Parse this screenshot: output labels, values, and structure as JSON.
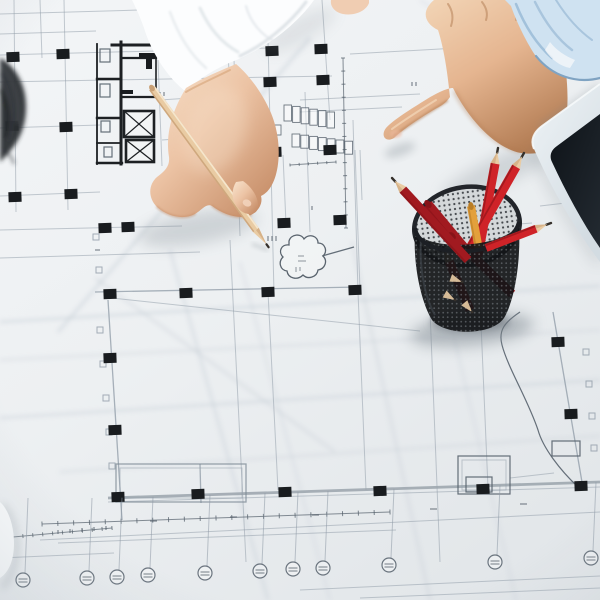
{
  "meta": {
    "title": "Architects reviewing blueprints",
    "description": "Top-down photo of two people over an architectural floor plan: one hand in a white sleeve holds a wooden pencil, another hand in a light blue sleeve points at the drawing, beside a black mesh cup full of red pencils and the corner of a tablet."
  },
  "colors": {
    "paper_hi": "#f3f5f7",
    "paper": "#edf0f2",
    "paper_lo": "#e3e7ea",
    "line": "#8e9aa6",
    "line_dark": "#55606b",
    "thick_gray": "#9aa4ac",
    "ink": "#191c1f",
    "wall": "#1d2023",
    "crease": "#c2cbd3",
    "skin_left": "#ecc3a4",
    "skin_left_hi": "#f8e3cd",
    "skin_left_sh": "#c48a64",
    "skin_right": "#e5b590",
    "skin_right_hi": "#f4d9bb",
    "skin_right_sh": "#b07950",
    "sleeve_white": "#fcfdfe",
    "sleeve_white_sh": "#e0e5e9",
    "sleeve_blue": "#cfe2f1",
    "sleeve_blue_sh": "#8fb3d1",
    "pencil_wood": "#e9cba3",
    "pencil_wood_dark": "#c9a075",
    "lead": "#35302b",
    "red": "#cf2328",
    "red_dark": "#a11a20",
    "red_deep": "#871318",
    "orange": "#e3a03c",
    "cup": "#131518",
    "cup_dot": "#878d93",
    "cup_interior": "#d4d8da",
    "tablet_bezel": "#e6edf2",
    "tablet_screen": "#161b21",
    "hair": "#2c2e32",
    "sheet": "#f8fafb",
    "shadow": "#7e8890"
  },
  "blueprint": {
    "columns": [
      [
        13,
        57
      ],
      [
        63,
        54
      ],
      [
        272,
        51
      ],
      [
        321,
        49
      ],
      [
        270,
        82
      ],
      [
        323,
        80
      ],
      [
        12,
        126
      ],
      [
        66,
        127
      ],
      [
        15,
        197
      ],
      [
        71,
        194
      ],
      [
        105,
        228
      ],
      [
        128,
        227
      ],
      [
        275,
        152
      ],
      [
        330,
        150
      ],
      [
        284,
        223
      ],
      [
        340,
        220
      ],
      [
        110,
        294
      ],
      [
        186,
        293
      ],
      [
        268,
        292
      ],
      [
        355,
        290
      ],
      [
        110,
        358
      ],
      [
        115,
        430
      ],
      [
        118,
        497
      ],
      [
        198,
        494
      ],
      [
        285,
        492
      ],
      [
        380,
        491
      ],
      [
        483,
        489
      ],
      [
        581,
        486
      ],
      [
        558,
        342
      ],
      [
        571,
        414
      ]
    ],
    "bubbles": [
      [
        23,
        580
      ],
      [
        87,
        578
      ],
      [
        117,
        577
      ],
      [
        148,
        575
      ],
      [
        205,
        573
      ],
      [
        260,
        571
      ],
      [
        293,
        569
      ],
      [
        323,
        568
      ],
      [
        389,
        565
      ],
      [
        495,
        562
      ],
      [
        591,
        558
      ]
    ],
    "tick_rows": [
      [
        42,
        524,
        390,
        512,
        22,
        5
      ],
      [
        343,
        58,
        346,
        228,
        13,
        4
      ],
      [
        290,
        165,
        336,
        162,
        5,
        3
      ],
      [
        13,
        537,
        112,
        528,
        10,
        4
      ]
    ],
    "stall_rows": [
      {
        "x": 284,
        "y": 105,
        "cols": 6,
        "w": 7.5,
        "h": 16,
        "dx": 8.6,
        "dy": 1.4
      },
      {
        "x": 292,
        "y": 134,
        "cols": 7,
        "w": 7.8,
        "h": 13,
        "dx": 8.8,
        "dy": 1.2
      },
      {
        "x": 252,
        "y": 122,
        "cols": 4,
        "w": 6.5,
        "h": 10,
        "dx": 7.5,
        "dy": 1
      }
    ],
    "tick_squares": [
      [
        100,
        330
      ],
      [
        103,
        364
      ],
      [
        106,
        398
      ],
      [
        109,
        432
      ],
      [
        112,
        466
      ],
      [
        586,
        352
      ],
      [
        589,
        384
      ],
      [
        592,
        416
      ],
      [
        594,
        448
      ],
      [
        96,
        237
      ],
      [
        99,
        270
      ]
    ],
    "marks": [
      [
        268,
        236,
        5,
        90
      ],
      [
        272,
        236,
        5,
        90
      ],
      [
        276,
        236,
        5,
        90
      ],
      [
        296,
        267,
        5,
        90
      ],
      [
        300,
        267,
        4,
        90
      ],
      [
        298,
        256,
        6,
        0
      ],
      [
        298,
        261,
        8,
        0
      ],
      [
        150,
        521,
        7,
        0
      ],
      [
        230,
        517,
        7,
        0
      ],
      [
        312,
        515,
        7,
        0
      ],
      [
        430,
        509,
        7,
        0
      ],
      [
        520,
        504,
        7,
        0
      ],
      [
        95,
        250,
        5,
        0
      ],
      [
        160,
        92,
        4,
        90
      ],
      [
        164,
        92,
        4,
        90
      ],
      [
        312,
        206,
        4,
        90
      ],
      [
        412,
        82,
        4,
        90
      ],
      [
        416,
        82,
        4,
        90
      ],
      [
        58,
        530,
        4,
        90
      ],
      [
        70,
        529,
        4,
        90
      ],
      [
        82,
        528,
        4,
        90
      ],
      [
        94,
        527,
        4,
        90
      ],
      [
        106,
        526,
        4,
        90
      ],
      [
        240,
        160,
        4,
        90
      ],
      [
        244,
        160,
        4,
        90
      ]
    ],
    "lines": {
      "f": [
        [
          0,
          14,
          140,
          10
        ],
        [
          0,
          34,
          96,
          31
        ],
        [
          0,
          55,
          270,
          48
        ],
        [
          0,
          82,
          332,
          76
        ],
        [
          0,
          128,
          100,
          125
        ],
        [
          0,
          196,
          100,
          192
        ],
        [
          0,
          230,
          182,
          226
        ],
        [
          14,
          0,
          16,
          212
        ],
        [
          40,
          0,
          42,
          58
        ],
        [
          64,
          0,
          68,
          210
        ],
        [
          160,
          60,
          230,
          55
        ],
        [
          160,
          100,
          236,
          95
        ],
        [
          162,
          140,
          230,
          135
        ],
        [
          228,
          55,
          233,
          136
        ],
        [
          158,
          60,
          162,
          166
        ],
        [
          232,
          0,
          240,
          236
        ],
        [
          268,
          40,
          274,
          294
        ],
        [
          305,
          92,
          310,
          232
        ],
        [
          322,
          0,
          330,
          120
        ],
        [
          350,
          54,
          600,
          40
        ],
        [
          300,
          100,
          420,
          94
        ],
        [
          300,
          112,
          402,
          107
        ],
        [
          540,
          206,
          600,
          199
        ],
        [
          430,
          231,
          532,
          223
        ],
        [
          355,
          150,
          360,
          290
        ],
        [
          283,
          155,
          286,
          224
        ],
        [
          353,
          120,
          358,
          292
        ],
        [
          0,
          258,
          200,
          252
        ],
        [
          112,
          298,
          420,
          331
        ],
        [
          230,
          240,
          246,
          562
        ],
        [
          268,
          292,
          278,
          490
        ],
        [
          358,
          292,
          366,
          490
        ],
        [
          430,
          310,
          440,
          562
        ],
        [
          480,
          300,
          488,
          488
        ],
        [
          40,
          540,
          600,
          512
        ],
        [
          58,
          543,
          396,
          530
        ],
        [
          0,
          558,
          114,
          553
        ],
        [
          300,
          590,
          600,
          576
        ],
        [
          360,
          598,
          600,
          588
        ],
        [
          510,
          478,
          554,
          473
        ],
        [
          360,
          150,
          362,
          200
        ],
        [
          108,
          502,
          600,
          487
        ]
      ],
      "m": [
        [
          95,
          292,
          360,
          287
        ],
        [
          108,
          300,
          122,
          520
        ],
        [
          553,
          312,
          583,
          488
        ],
        [
          200,
          464,
          201,
          503
        ]
      ],
      "g": [
        [
          108,
          498,
          600,
          482
        ]
      ],
      "d": [
        [
          322,
          256,
          354,
          247
        ]
      ]
    },
    "creases": [
      [
        310,
        38,
        58,
        332,
        3,
        0.45
      ],
      [
        95,
        278,
        335,
        452,
        2.5,
        0.4
      ],
      [
        0,
        322,
        600,
        286,
        2.5,
        0.5
      ],
      [
        0,
        360,
        600,
        330,
        2,
        0.4
      ],
      [
        0,
        418,
        600,
        380,
        2.5,
        0.45
      ],
      [
        60,
        472,
        600,
        436,
        2,
        0.4
      ],
      [
        170,
        250,
        268,
        600,
        2.5,
        0.45
      ],
      [
        240,
        262,
        330,
        600,
        2,
        0.35
      ],
      [
        352,
        242,
        430,
        600,
        2.5,
        0.4
      ],
      [
        436,
        260,
        516,
        600,
        2,
        0.35
      ],
      [
        420,
        0,
        560,
        90,
        2,
        0.3
      ]
    ]
  },
  "cup": {
    "pencils_inside": [
      [
        498,
        148,
        478,
        256,
        9,
        "red",
        "sharp"
      ],
      [
        524,
        153,
        470,
        248,
        9,
        "red",
        "sharp"
      ],
      [
        428,
        204,
        468,
        252,
        9,
        "red_dark",
        "blunt"
      ],
      [
        471,
        206,
        479,
        250,
        8,
        "orange",
        "blunt"
      ],
      [
        452,
        236,
        512,
        294,
        9,
        "red_dark",
        "blunt"
      ],
      [
        443,
        247,
        470,
        310,
        9,
        "red",
        "sharp"
      ]
    ],
    "pencils_front": [
      [
        392,
        178,
        468,
        260,
        9,
        "red_dark",
        "sharp"
      ],
      [
        551,
        223,
        486,
        248,
        8,
        "red",
        "sharp"
      ]
    ],
    "wood_tips": [
      [
        455,
        300,
        210
      ],
      [
        472,
        312,
        230
      ],
      [
        462,
        282,
        200
      ]
    ]
  }
}
